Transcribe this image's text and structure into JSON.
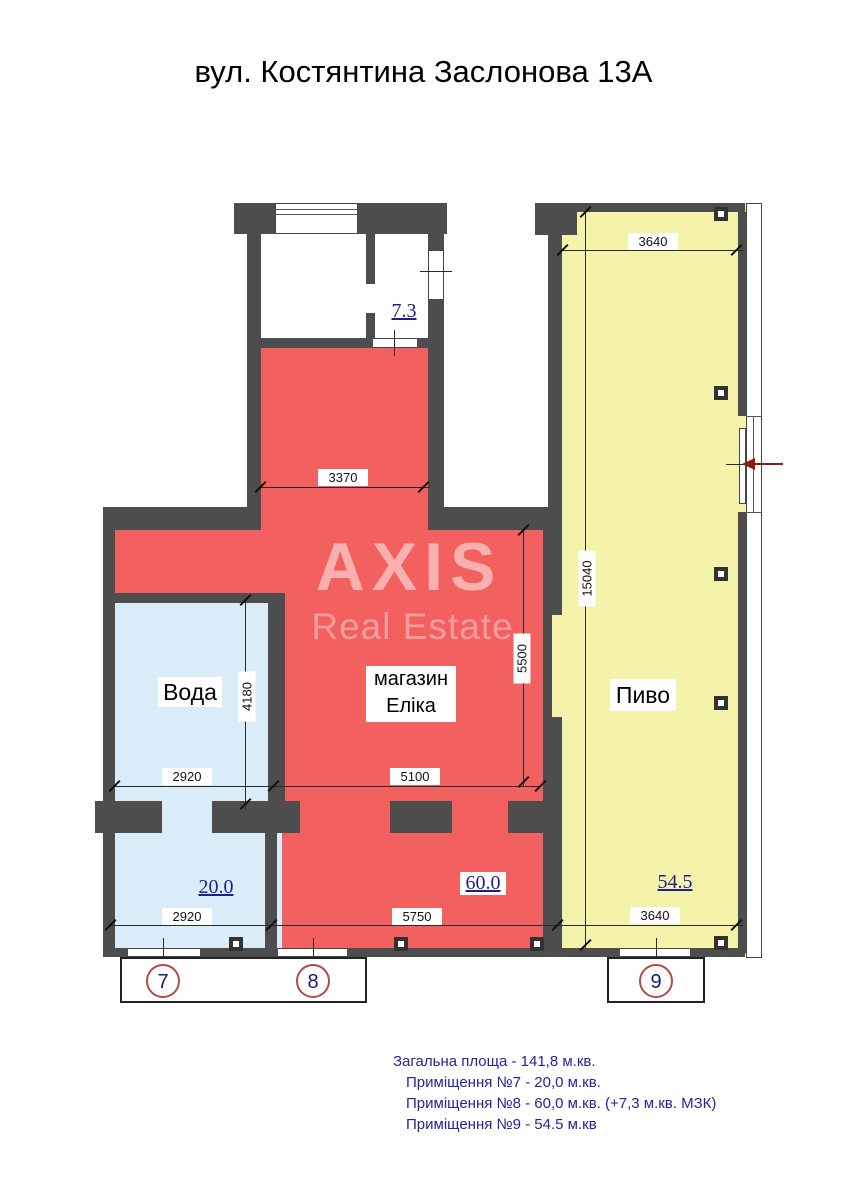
{
  "title": "вул. Костянтина Заслонова 13А",
  "watermark": {
    "line1": "AXIS",
    "line2": "Real Estate"
  },
  "rooms": {
    "mzk": {
      "area": "7.3"
    },
    "voda": {
      "name": "Вода",
      "area": "20.0",
      "unit": "7"
    },
    "shop": {
      "name_line1": "магазин",
      "name_line2": "Еліка",
      "area": "60.0",
      "unit": "8"
    },
    "pivo": {
      "name": "Пиво",
      "area": "54.5",
      "unit": "9"
    }
  },
  "dimensions": {
    "pivo_top": "3640",
    "shop_top": "3370",
    "right_total": "15040",
    "shop_right": "5500",
    "voda_right": "4180",
    "voda_mid": "2920",
    "shop_mid": "5100",
    "voda_bottom": "2920",
    "shop_bottom": "5750",
    "pivo_bottom": "3640"
  },
  "summary": {
    "line1": "Загальна площа - 141,8 м.кв.",
    "line2": "Приміщення №7 - 20,0 м.кв.",
    "line3": "Приміщення №8 - 60,0 м.кв. (+7,3 м.кв. МЗК)",
    "line4": "Приміщення №9 - 54.5 м.кв"
  },
  "colors": {
    "wall": "#4d4d4d",
    "red": "#f2605f",
    "blue": "#d9ecf8",
    "yellow": "#f5f3aa",
    "navy": "#1e1e8f",
    "circle_outline": "#b34a4a",
    "arrow": "#8b1a1a",
    "summary_text": "#24249c"
  }
}
